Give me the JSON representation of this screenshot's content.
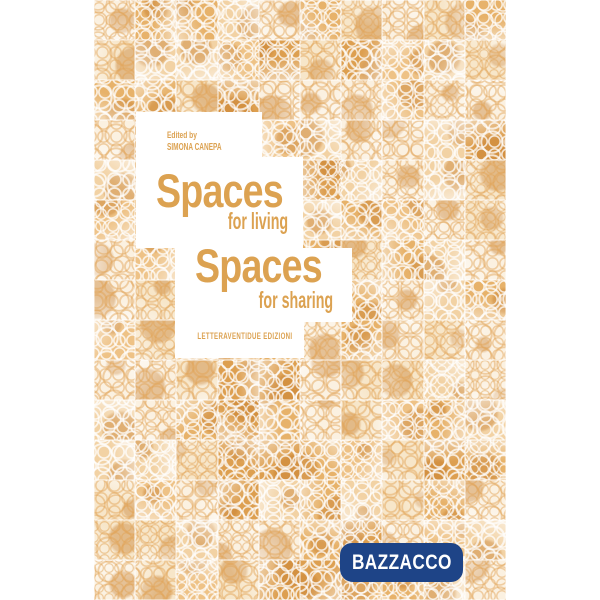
{
  "cover": {
    "edited_by_label": "Edited by",
    "editor_name": "SIMONA CANEPA",
    "title_line1": "Spaces",
    "subtitle_line1": "for living",
    "title_line2": "Spaces",
    "subtitle_line2": "for sharing",
    "publisher": "LETTERAVENTIDUE EDIZIONI"
  },
  "badge": {
    "label": "BAZZACCO"
  },
  "colors": {
    "accent_orange": "#dca251",
    "badge_blue": "#1e4487",
    "badge_text": "#ffffff",
    "panel_white": "#ffffff",
    "mosaic_seam": "rgba(255,255,255,0.45)",
    "mosaic_palette": [
      "#dd9f50",
      "#e7b26a",
      "#eec286",
      "#f2d2a4",
      "#f7e6c9",
      "#fbf1e1"
    ],
    "mosaic_blob": "rgba(198,126,47,0.42)"
  }
}
